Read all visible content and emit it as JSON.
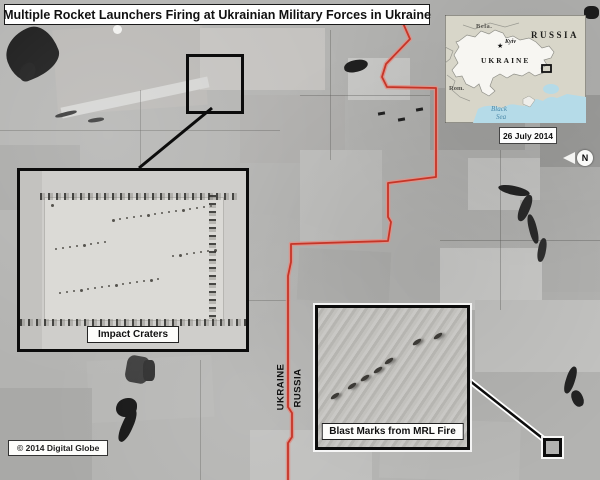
{
  "title": "Multiple Rocket Launchers Firing at Ukrainian Military Forces in Ukraine",
  "locator_map": {
    "russia_label": "RUSSIA",
    "ukraine_label": "UKRAINE",
    "belarus_label": "Bela.",
    "romania_label": "Rom.",
    "kyiv_label": "Kyiv",
    "kyiv_star": "★",
    "black_sea_label_line1": "Black",
    "black_sea_label_line2": "Sea",
    "date": "26 July 2014"
  },
  "compass": {
    "north_label": "N"
  },
  "callouts": {
    "impact_craters_label": "Impact Craters",
    "blast_marks_label": "Blast Marks from MRL Fire"
  },
  "border_labels": {
    "ukraine": "UKRAINE",
    "russia": "RUSSIA"
  },
  "copyright": "© 2014 Digital Globe",
  "colors": {
    "border_line_red": "#c63527",
    "border_line_halo": "#dd9289",
    "sea_blue": "#b5dbe8",
    "land_beige": "#d8d6c9",
    "ukraine_fill": "#f7f6f2",
    "annotation_black": "#0c0c0c"
  }
}
